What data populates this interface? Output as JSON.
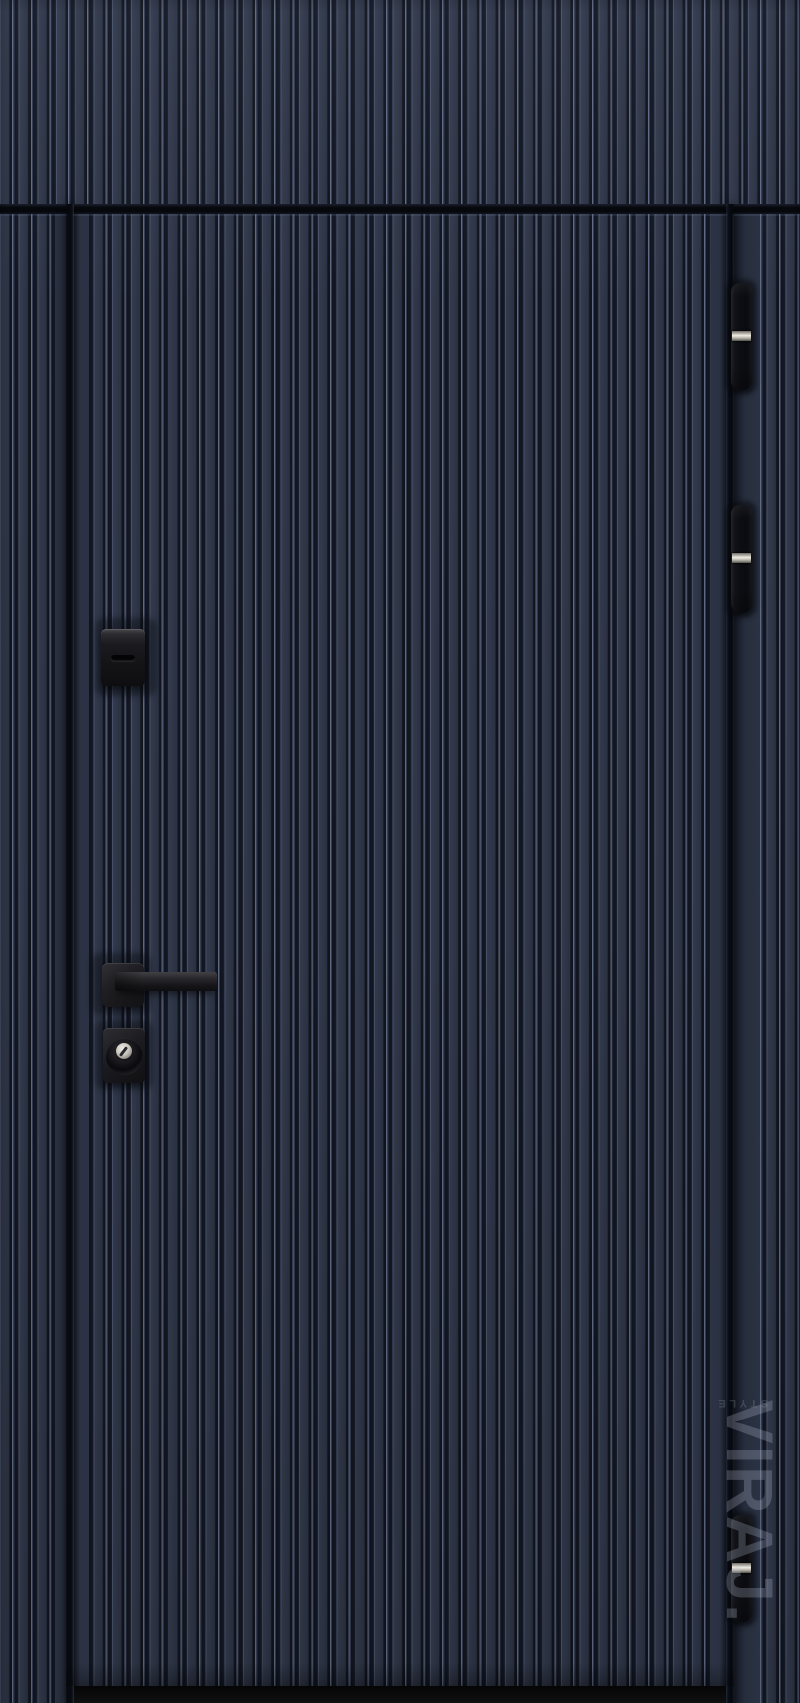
{
  "image": {
    "description": "Front view of a closed navy-blue entry door with vertical fluted ribbing, transom panel above, black square-rose lever handle, upper lock cover, key cylinder and three black barrel hinges with steel bands",
    "colors": {
      "panel_face": "#2c3344",
      "rib_highlight": "#5e6984",
      "rib_groove": "#10141d",
      "hardware_black": "#141418",
      "hinge_steel": "#efece4",
      "threshold": "#0a0a0b"
    }
  },
  "watermark": {
    "brand": "VIRAJ.",
    "tagline": "STYLE"
  }
}
